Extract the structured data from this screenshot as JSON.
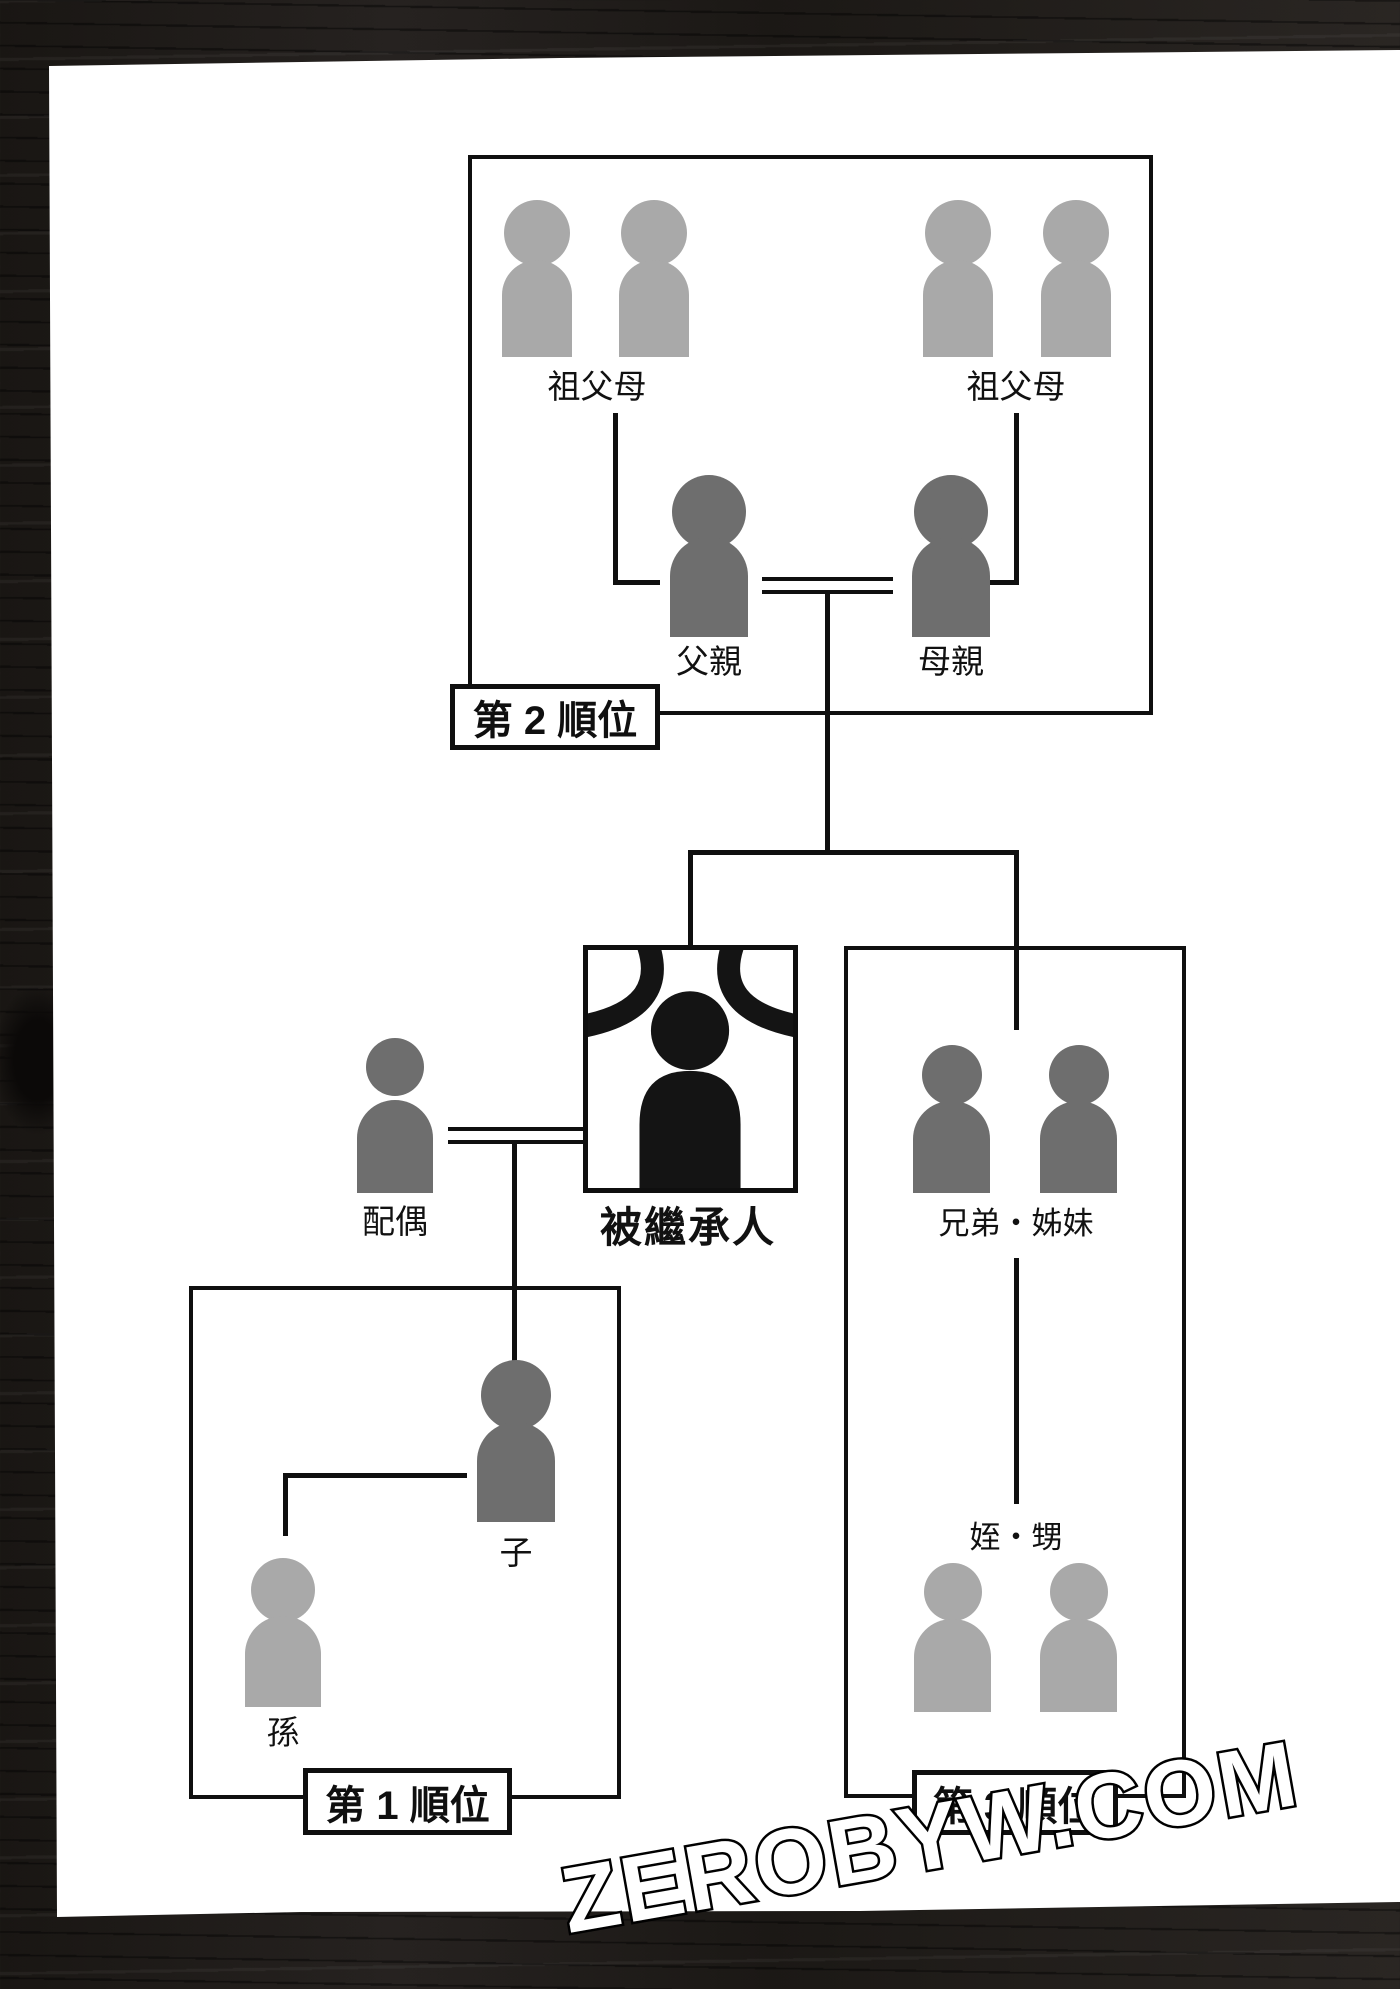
{
  "watermark": {
    "text": "ZEROBYW.COM"
  },
  "colors": {
    "page": "#ffffff",
    "wood": "#1d1a17",
    "line": "#0f0f0f",
    "figure_light": "#a9a9a9",
    "figure_dark": "#6e6e6e",
    "figure_black": "#141414"
  },
  "diagram": {
    "rank2_box": {
      "label": "第 2 順位",
      "grandparents_left": "祖父母",
      "grandparents_right": "祖父母",
      "father": "父親",
      "mother": "母親"
    },
    "decedent": {
      "label": "被繼承人"
    },
    "spouse": {
      "label": "配偶"
    },
    "rank1_box": {
      "label": "第 1 順位",
      "child": "子",
      "grandchild": "孫"
    },
    "rank3_box": {
      "label": "第 3 順位",
      "siblings": "兄弟・姊妹",
      "nieces_nephews": "姪・甥"
    }
  }
}
